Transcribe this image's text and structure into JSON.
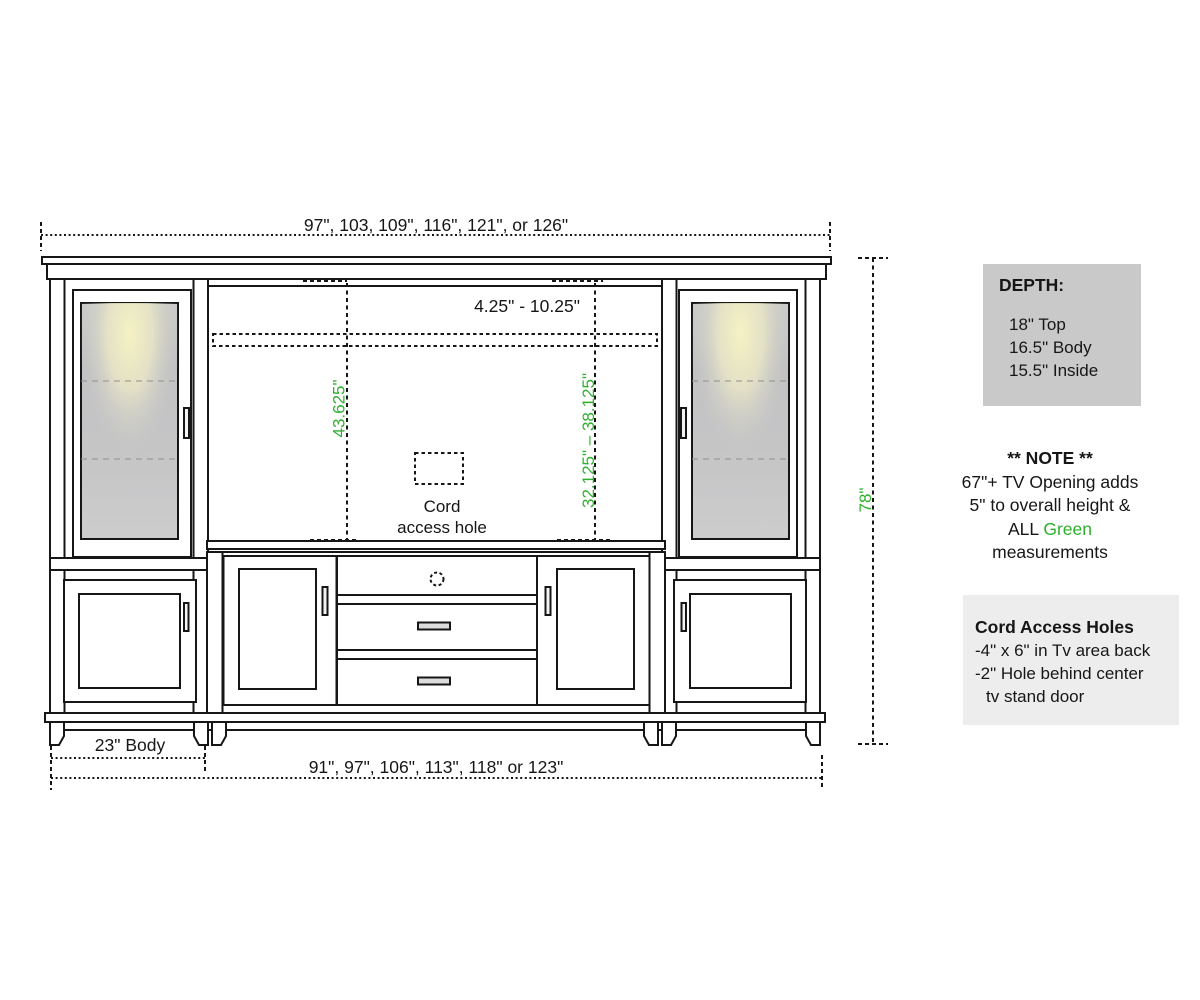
{
  "colors": {
    "green_accent": "#2eb02e",
    "line": "#161616",
    "depth_panel_bg": "#c9c9c9",
    "cord_panel_bg": "#ededed"
  },
  "drawing": {
    "dims": {
      "top_width": "97\", 103, 109\", 116\", 121\", or 126\"",
      "tv_opening_width_gap": "4.25\" - 10.25\"",
      "left_opening_height": "43.625\"",
      "right_opening_height": "32.125\" – 38.125\"",
      "overall_height": "78\"",
      "body_width": "23\" Body",
      "bottom_width": "91\", 97\", 106\", 113\", 118\" or 123\""
    },
    "cord_hole": {
      "line1": "Cord",
      "line2": "access hole"
    }
  },
  "depth_panel": {
    "title": "DEPTH:",
    "items": [
      "18\" Top",
      "16.5\" Body",
      "15.5\" Inside"
    ]
  },
  "note_panel": {
    "title": "** NOTE **",
    "line1": "67\"+ TV Opening adds",
    "line2": "5\" to overall height &",
    "line3_black": "ALL ",
    "line3_green": "Green",
    "line4": "measurements"
  },
  "cord_panel": {
    "title": "Cord Access Holes",
    "line1": "-4\" x 6\" in Tv area back",
    "line2": "-2\" Hole behind center",
    "line3": "tv stand door"
  }
}
